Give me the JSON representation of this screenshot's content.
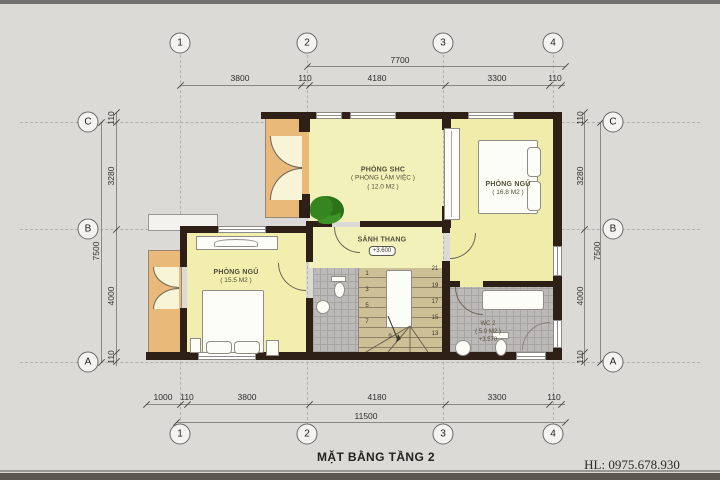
{
  "title": "MẶT BẰNG TẦNG 2",
  "watermark": "HL: 0975.678.930",
  "grid": {
    "cols": [
      "1",
      "2",
      "3",
      "4"
    ],
    "rows": [
      "C",
      "B",
      "A"
    ]
  },
  "dims": {
    "top_total": "7700",
    "top_segments": [
      "3800",
      "110",
      "4180",
      "3300",
      "110"
    ],
    "bottom_segments": [
      "1000",
      "110",
      "3800",
      "4180",
      "3300",
      "110"
    ],
    "bottom_total": "11500",
    "side_segments": [
      "110",
      "3280",
      "4000",
      "110"
    ],
    "side_total": "7500"
  },
  "rooms": {
    "shc": {
      "name": "PHÒNG SHC",
      "sub": "( PHÒNG LÀM VIỆC )",
      "area": "( 12.0 M2 )"
    },
    "bed1": {
      "name": "PHÒNG NGỦ",
      "area": "( 16.8 M2 )"
    },
    "bed2": {
      "name": "PHÒNG NGỦ",
      "area": "( 15.5 M2 )"
    },
    "stair_hall": {
      "name": "SẢNH THANG",
      "level": "+3.600"
    },
    "wc": {
      "name": "WC 2",
      "area": "( 5.0 M2 )",
      "level": "+3.570"
    }
  },
  "stairs": {
    "numbers_left": [
      "1",
      "3",
      "5",
      "7"
    ],
    "numbers_right": [
      "21",
      "19",
      "17",
      "15",
      "13"
    ],
    "number_mid": "9"
  },
  "colors": {
    "background": "#dcdad7",
    "wall": "#2e2017",
    "room_fill": "#f3f1ba",
    "balcony_fill": "#e9b979",
    "stair_fill": "#cdc096",
    "tile_fill": "#bcbab8",
    "plant_green": "#2f7d1f"
  }
}
